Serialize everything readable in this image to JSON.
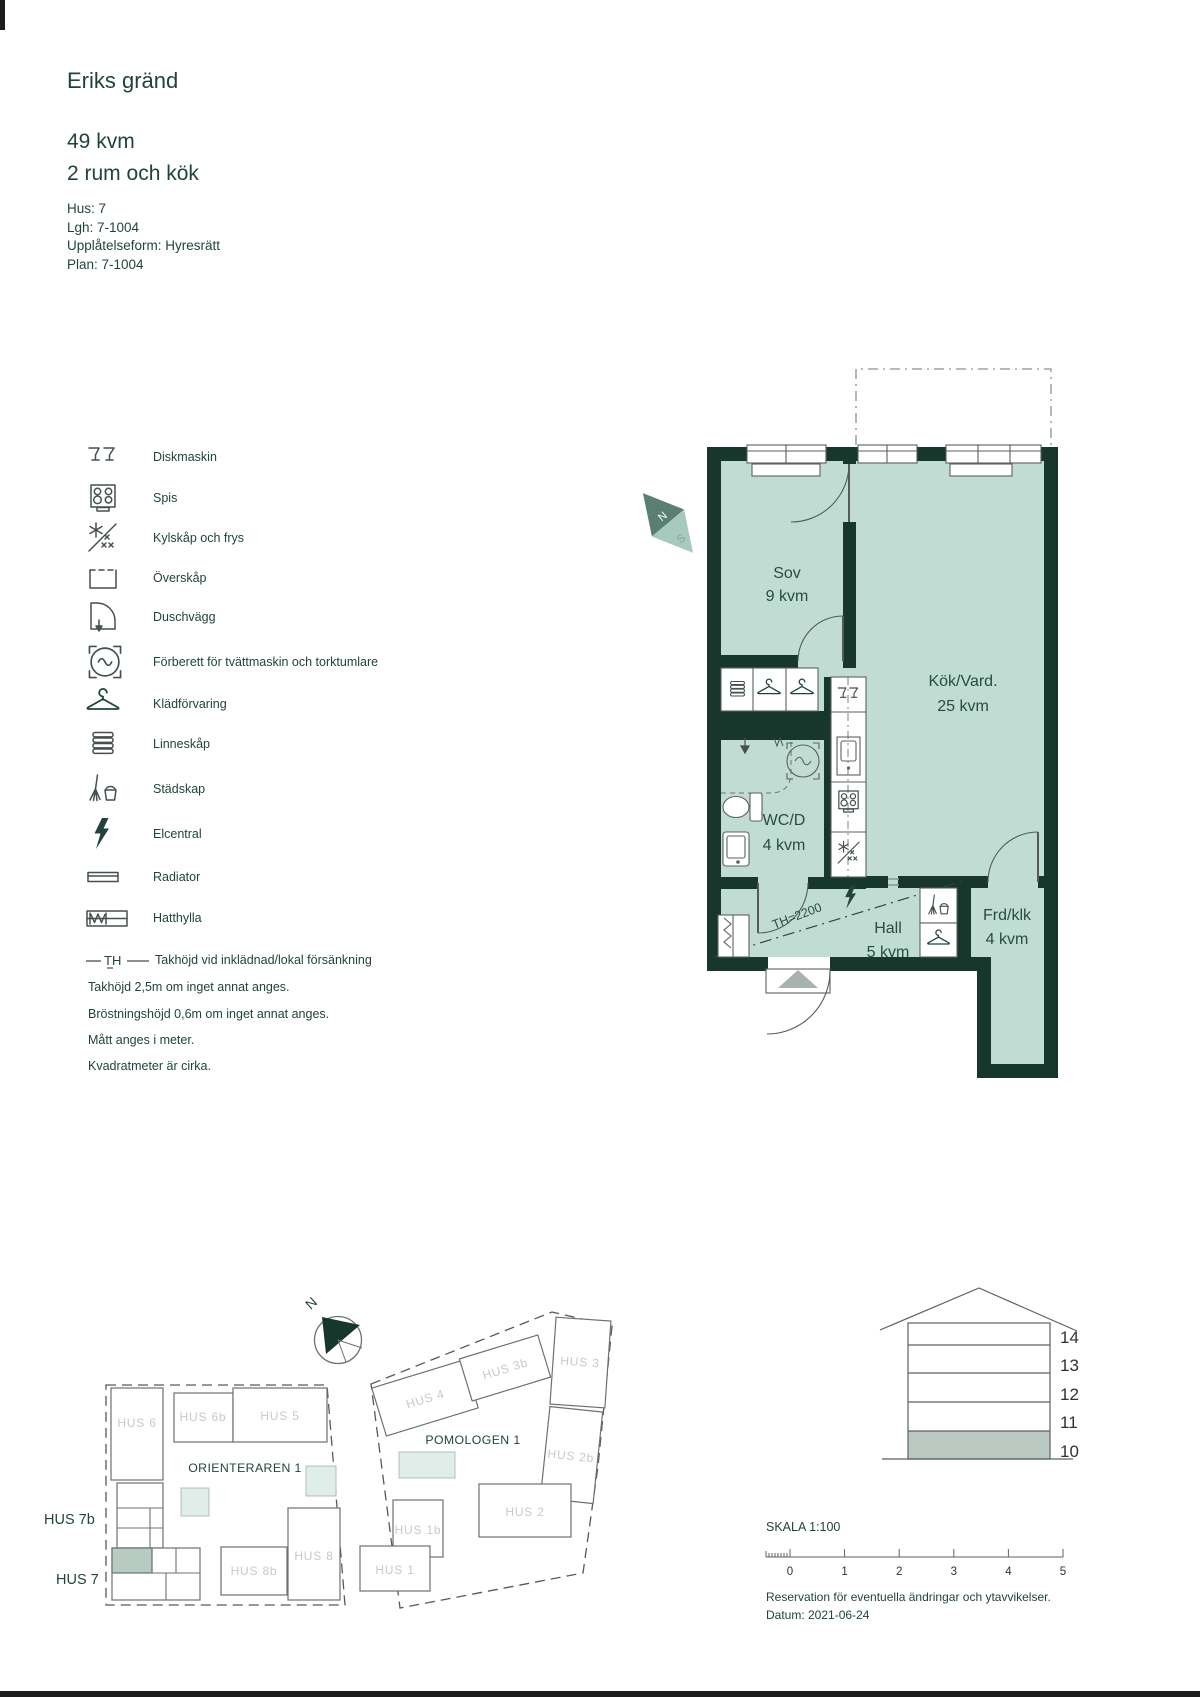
{
  "header": {
    "title": "Eriks gränd",
    "area": "49 kvm",
    "rooms": "2 rum och kök",
    "info": {
      "hus": "Hus: 7",
      "lgh": "Lgh: 7-1004",
      "upplatelseform": "Upplåtelseform: Hyresrätt",
      "plan": "Plan: 7-1004"
    }
  },
  "legend": {
    "items": [
      {
        "icon": "dishwasher-icon",
        "label": "Diskmaskin"
      },
      {
        "icon": "stove-icon",
        "label": "Spis"
      },
      {
        "icon": "fridge-freezer-icon",
        "label": "Kylskåp och frys"
      },
      {
        "icon": "wall-cabinet-icon",
        "label": "Överskåp"
      },
      {
        "icon": "shower-wall-icon",
        "label": "Duschvägg"
      },
      {
        "icon": "washer-prep-icon",
        "label": "Förberett för tvättmaskin och torktumlare"
      },
      {
        "icon": "clothes-storage-icon",
        "label": "Klädförvaring"
      },
      {
        "icon": "linen-cabinet-icon",
        "label": "Linneskåp"
      },
      {
        "icon": "cleaning-cabinet-icon",
        "label": "Städskap"
      },
      {
        "icon": "electrical-panel-icon",
        "label": "Elcentral"
      },
      {
        "icon": "radiator-icon",
        "label": "Radiator"
      },
      {
        "icon": "hat-shelf-icon",
        "label": "Hatthylla"
      },
      {
        "icon": "ceiling-height-symbol",
        "label": "Takhöjd vid inklädnad/lokal försänkning",
        "symbol": "TH"
      }
    ]
  },
  "notes": [
    "Takhöjd 2,5m om inget annat anges.",
    "Bröstningshöjd 0,6m om inget annat anges.",
    "Mått anges i meter.",
    "Kvadratmeter är cirka."
  ],
  "floor_plan": {
    "compass": {
      "north": "N",
      "south": "S"
    },
    "ceiling_height_label": "TH=2200",
    "rooms": {
      "sov": {
        "name": "Sov",
        "area": "9 kvm"
      },
      "kok": {
        "name": "Kök/Vard.",
        "area": "25 kvm"
      },
      "wc": {
        "name": "WC/D",
        "area": "4 kvm"
      },
      "hall": {
        "name": "Hall",
        "area": "5 kvm"
      },
      "frd": {
        "name": "Frd/klk",
        "area": "4 kvm"
      }
    }
  },
  "site_plan": {
    "north": "N",
    "area_orienteraren": "ORIENTERAREN 1",
    "area_pomologen": "POMOLOGEN 1",
    "hus": {
      "hus6": "HUS 6",
      "hus6b": "HUS 6b",
      "hus5": "HUS 5",
      "hus7b": "HUS 7b",
      "hus7": "HUS 7",
      "hus8b": "HUS 8b",
      "hus8": "HUS 8",
      "hus4": "HUS 4",
      "hus3b": "HUS 3b",
      "hus3": "HUS 3",
      "hus2b": "HUS 2b",
      "hus2": "HUS 2",
      "hus1b": "HUS 1b",
      "hus1": "HUS 1"
    }
  },
  "elevation": {
    "floors": [
      "14",
      "13",
      "12",
      "11",
      "10"
    ],
    "highlighted_floor": "10"
  },
  "scale_bar": {
    "label": "SKALA 1:100",
    "ticks": [
      "0",
      "1",
      "2",
      "3",
      "4",
      "5"
    ]
  },
  "footer": {
    "reservation": "Reservation för eventuella ändringar och ytavvikelser.",
    "datum": "Datum: 2021-06-24"
  },
  "colors": {
    "wall": "#17362c",
    "room_fill": "#c1dcd2",
    "accent_text": "#20443b",
    "gray_building_label": "#c6cac8",
    "highlight_unit": "#b7cbc2",
    "mint_light": "#dfeee9",
    "elevation_highlight": "#b9c9c1"
  }
}
